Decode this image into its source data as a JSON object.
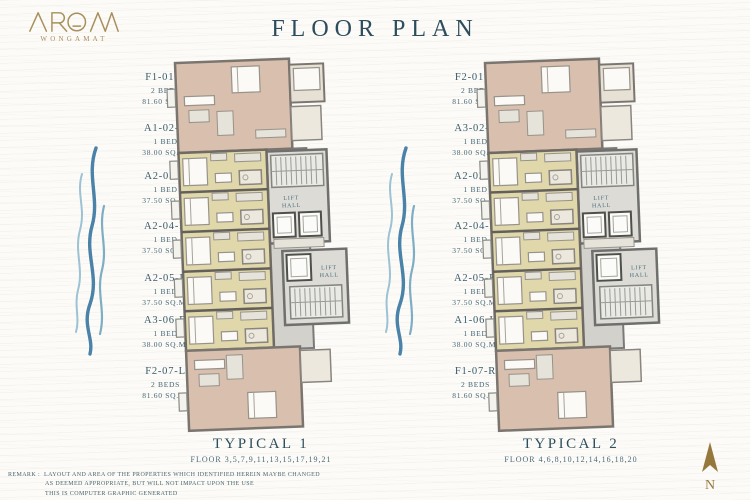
{
  "brand": {
    "name": "AROM",
    "subtitle": "WONGAMAT"
  },
  "title": "FLOOR PLAN",
  "plan_labels": {
    "lift": "LIFT",
    "hall": "HALL"
  },
  "plans": [
    {
      "name": "TYPICAL 1",
      "floors": "FLOOR 3,5,7,9,11,13,15,17,19,21",
      "units": [
        {
          "code": "F1-01-L",
          "type": "2 BEDS",
          "area": "81.60 SQ.M."
        },
        {
          "code": "A1-02-R",
          "type": "1 BED",
          "area": "38.00 SQ.M."
        },
        {
          "code": "A2-03-L",
          "type": "1 BED",
          "area": "37.50 SQ.M."
        },
        {
          "code": "A2-04-R",
          "type": "1 BED",
          "area": "37.50 SQ.M."
        },
        {
          "code": "A2-05-L",
          "type": "1 BED",
          "area": "37.50 SQ.M."
        },
        {
          "code": "A3-06-R",
          "type": "1 BED",
          "area": "38.00 SQ.M."
        },
        {
          "code": "F2-07-L",
          "type": "2 BEDS",
          "area": "81.60 SQ.M."
        }
      ]
    },
    {
      "name": "TYPICAL 2",
      "floors": "FLOOR 4,6,8,10,12,14,16,18,20",
      "units": [
        {
          "code": "F2-01-R",
          "type": "2 BEDS",
          "area": "81.60 SQ.M."
        },
        {
          "code": "A3-02-L",
          "type": "1 BED",
          "area": "38.00 SQ.M."
        },
        {
          "code": "A2-03-R",
          "type": "1 BED",
          "area": "37.50 SQ.M."
        },
        {
          "code": "A2-04-L",
          "type": "1 BED",
          "area": "37.50 SQ.M."
        },
        {
          "code": "A2-05-R",
          "type": "1 BED",
          "area": "37.50 SQ.M."
        },
        {
          "code": "A1-06-L",
          "type": "1 BED",
          "area": "38.00 SQ.M."
        },
        {
          "code": "F1-07-R",
          "type": "2 BEDS",
          "area": "81.60 SQ.M."
        }
      ]
    }
  ],
  "remark": {
    "label": "REMARK :",
    "line1": "LAYOUT AND AREA OF THE PROPERTIES WHICH IDENTIFIED HEREIN MAYBE CHANGED",
    "line2": "AS DEEMED APPROPRIATE, BUT WILL NOT IMPACT UPON THE USE",
    "line3": "THIS IS COMPUTER GRAPHIC GENERATED"
  },
  "compass": {
    "label": "N"
  },
  "colors": {
    "accent_gold": "#a8905c",
    "heading_teal": "#2d4d5c",
    "label_teal": "#3e6070",
    "wave_blue": "#4a82a8",
    "unit_pink": "#d8bfae",
    "unit_cream": "#e0d8ab",
    "wall_gray": "#6f6b64"
  }
}
